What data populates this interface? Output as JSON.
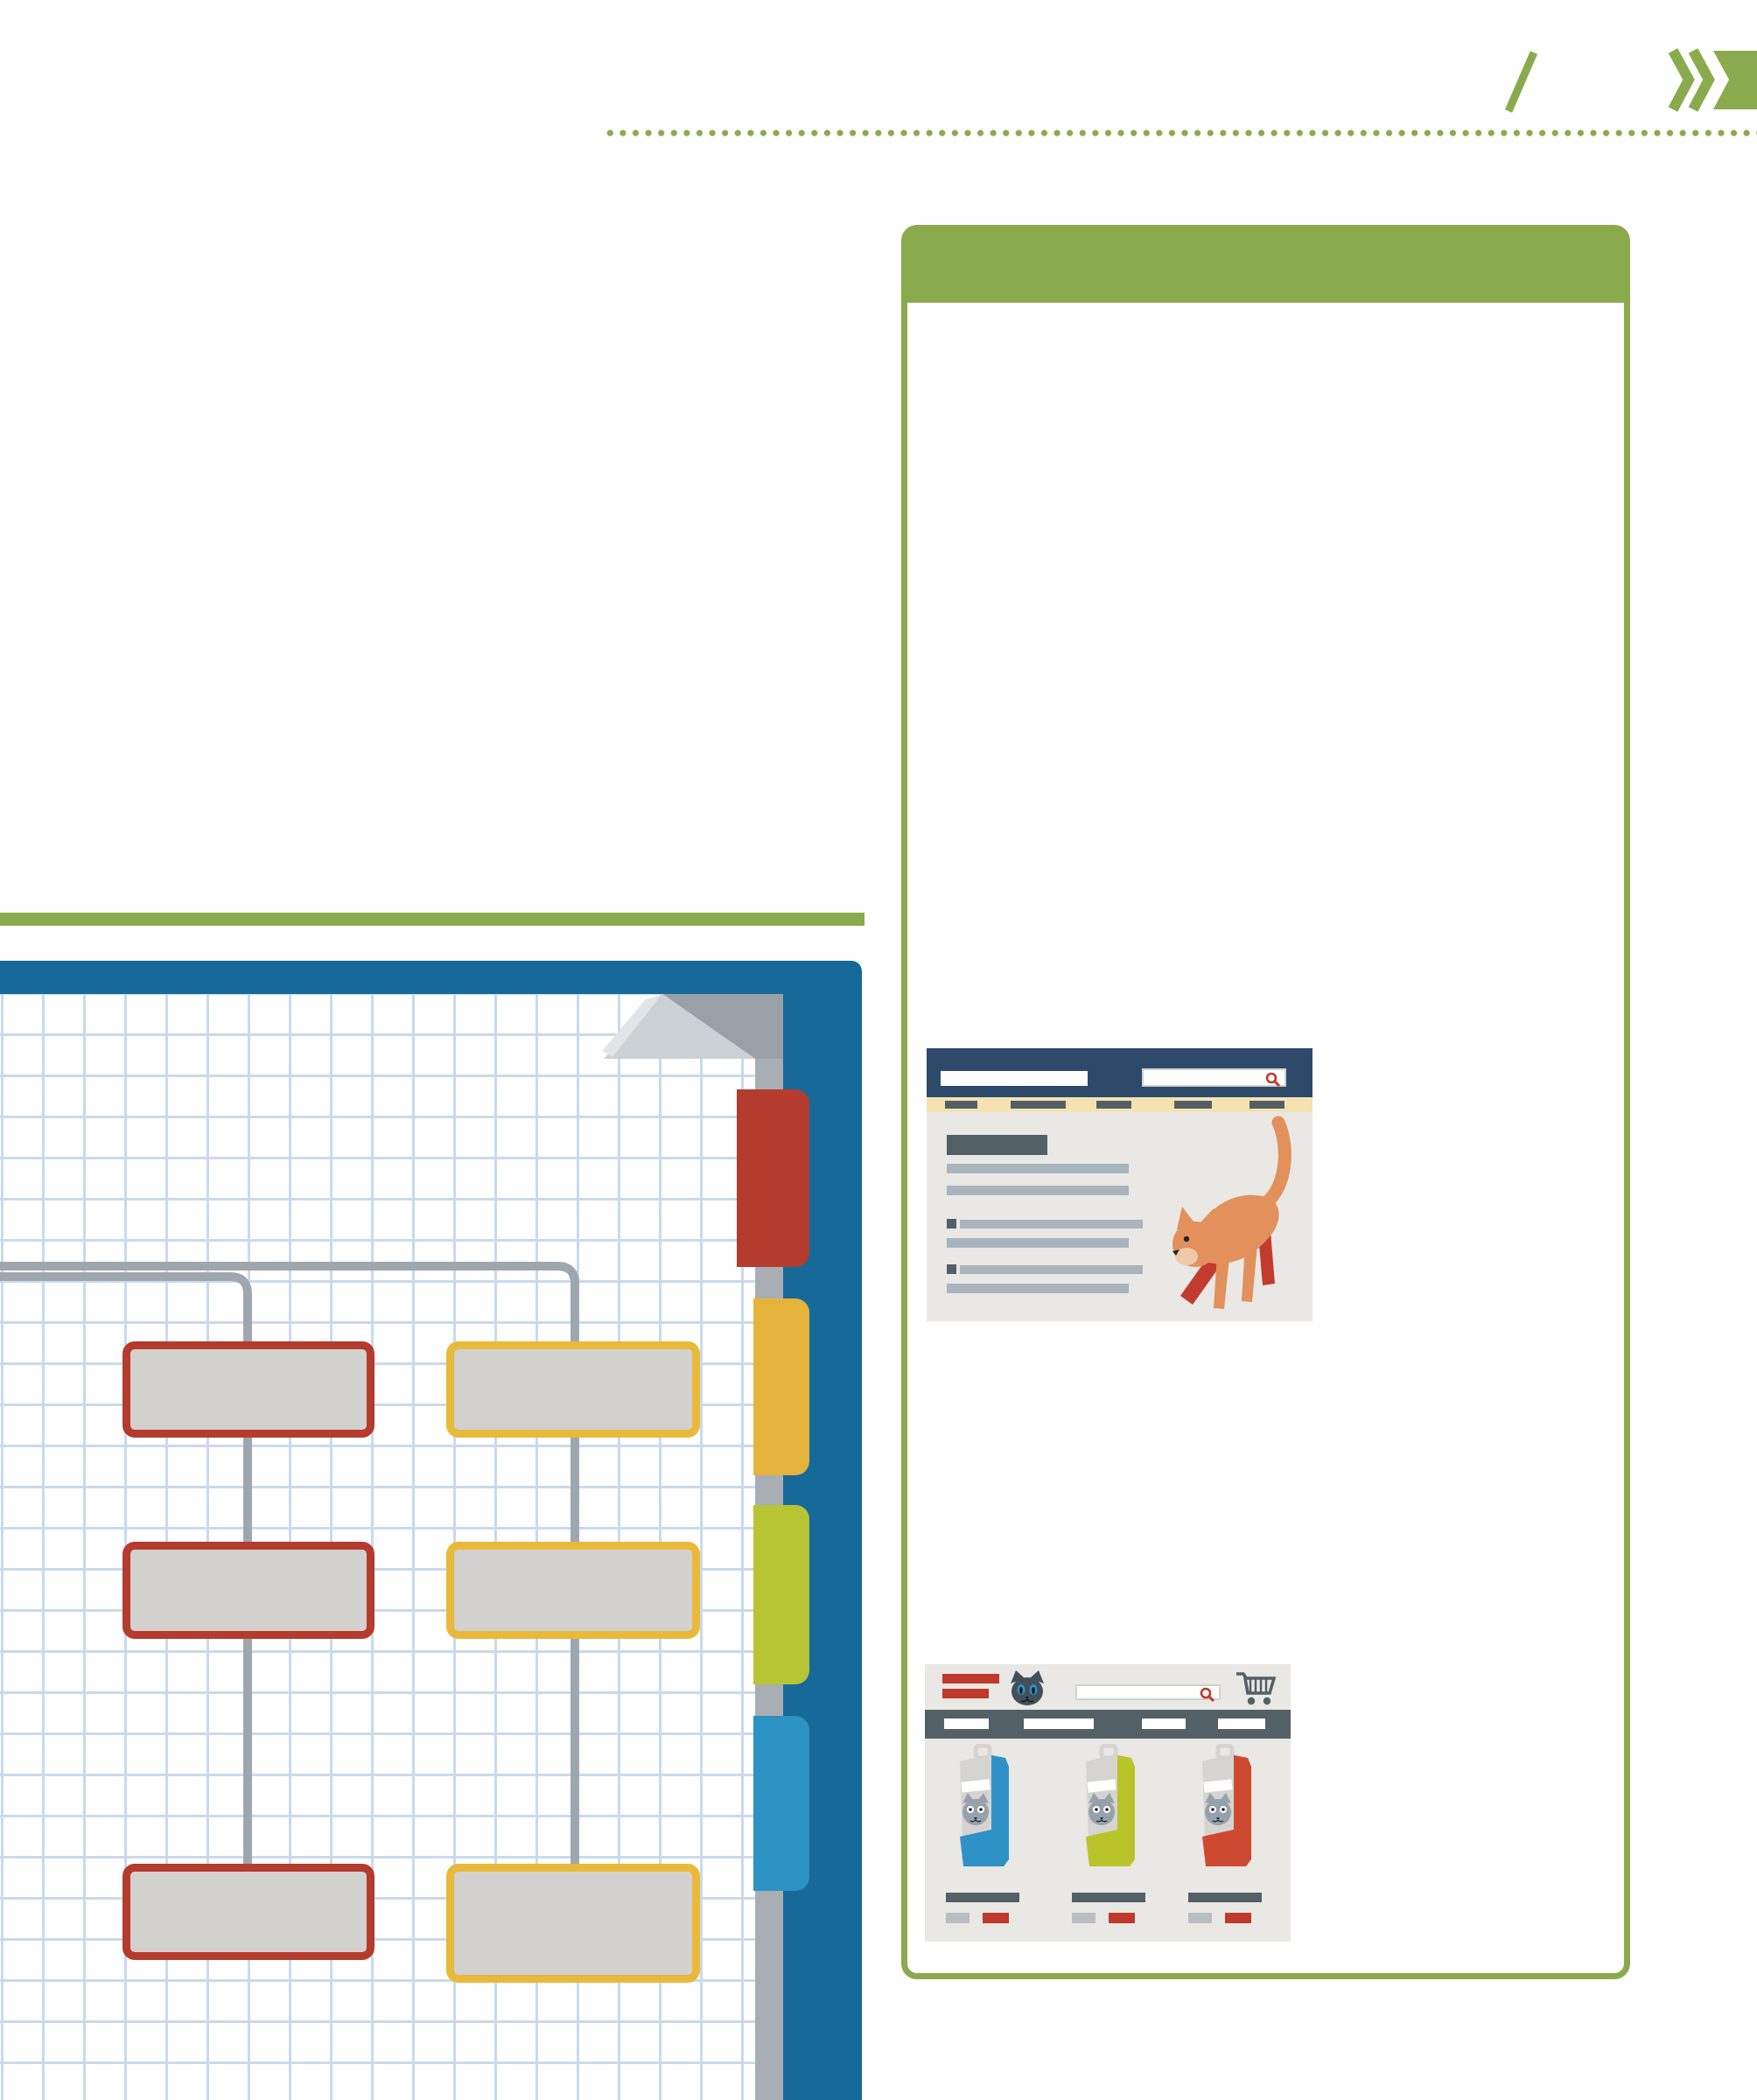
{
  "page": {
    "background": "#ffffff"
  },
  "decor": {
    "slash_icon_color": "#8aab4d",
    "chevron_icon_color": "#8aab4d",
    "chevron_count": 2,
    "dotted_line_color": "#8aab4d"
  },
  "green_bar": {
    "color": "#8aab4d"
  },
  "panel": {
    "border_color": "#8aab4d",
    "header_color": "#8aab4d",
    "background": "#ffffff"
  },
  "article_mockup": {
    "header_color": "#2d4a6b",
    "logo_placeholder_color": "#ffffff",
    "search_icon": "magnifier-icon",
    "search_icon_color": "#c0392c",
    "nav_bar_color": "#f5e2b3",
    "nav_item_color": "#536066",
    "nav_items": [
      {
        "w": 37
      },
      {
        "w": 63
      },
      {
        "w": 40
      },
      {
        "w": 43
      },
      {
        "w": 40
      }
    ],
    "content_background": "#e9e8e4",
    "content_rows": [
      {
        "type": "heading"
      },
      {
        "type": "line"
      },
      {
        "type": "line"
      },
      {
        "type": "bullet-line"
      },
      {
        "type": "line"
      },
      {
        "type": "bullet-line"
      },
      {
        "type": "line"
      }
    ],
    "cat": {
      "body_color": "#e2915c",
      "muzzle_color": "#f0c9a8",
      "boot_color": "#c23b2e"
    }
  },
  "shop_mockup": {
    "header_color": "#e9e8e4",
    "logo_bar_color": "#c0392c",
    "cat_logo_color": "#42505a",
    "cat_logo_eye_color": "#2f92c6",
    "search_icon": "magnifier-icon",
    "search_icon_color": "#c0392c",
    "cart_icon_color": "#536066",
    "nav_bar_color": "#536066",
    "nav_item_color": "#ffffff",
    "nav_items": [
      {
        "w": 51
      },
      {
        "w": 80
      },
      {
        "w": 50
      },
      {
        "w": 54
      }
    ],
    "products": [
      {
        "bag_color": "#2f92c6"
      },
      {
        "bag_color": "#b9c42a"
      },
      {
        "bag_color": "#cd4a31"
      }
    ],
    "product_card": {
      "bag_paper_color": "#d6d4d1",
      "label_face_color": "#96a1ab",
      "title_bar_color": "#536066",
      "meta_color": "#b9bec2",
      "price_color": "#c0392c"
    }
  },
  "notebook": {
    "cover_color": "#17699a",
    "paper_color": "#ffffff",
    "grid_color": "#c9daed",
    "page_edge_color": "#a9aeb4",
    "fold_colors": {
      "under": "#99a0a7",
      "flap": "#ccd1d5",
      "highlight": "#e2e5e8"
    },
    "tabs": [
      {
        "name": "red",
        "color": "#b43b2d"
      },
      {
        "name": "amber",
        "color": "#e5b33c"
      },
      {
        "name": "lime",
        "color": "#b7c433"
      },
      {
        "name": "blue",
        "color": "#2b92c3"
      }
    ],
    "sitemap": {
      "connector_color": "#9fa7ae",
      "box_fill": "#d3d1cd",
      "columns": [
        {
          "name": "red-column",
          "border_color": "#b43b2d",
          "boxes": 3
        },
        {
          "name": "yellow-column",
          "border_color": "#e9b93c",
          "boxes": 3
        }
      ]
    }
  }
}
